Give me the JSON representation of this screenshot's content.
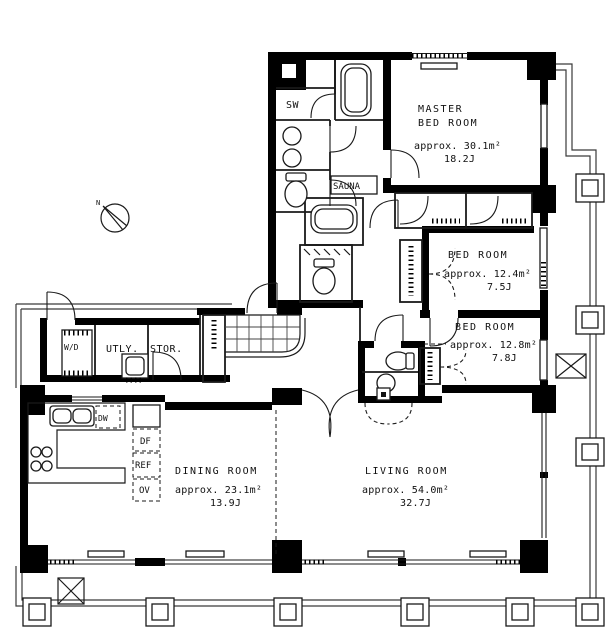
{
  "plan": {
    "type": "apartment-floor-plan",
    "rooms": [
      {
        "name": "MASTER",
        "name2": "BED ROOM",
        "area": "approx. 30.1m²",
        "tatami": "18.2J"
      },
      {
        "name": "BED ROOM",
        "area": "approx. 12.4m²",
        "tatami": "7.5J"
      },
      {
        "name": "BED ROOM",
        "area": "approx. 12.8m²",
        "tatami": "7.8J"
      },
      {
        "name": "DINING ROOM",
        "area": "approx. 23.1m²",
        "tatami": "13.9J"
      },
      {
        "name": "LIVING ROOM",
        "area": "approx. 54.0m²",
        "tatami": "32.7J"
      }
    ],
    "labels": {
      "shower": "SW",
      "sauna": "SAUNA",
      "utility": "UTLY.",
      "storage": "STOR.",
      "washer": "W/D",
      "dishwasher": "DW",
      "freezer": "DF",
      "fridge": "REF",
      "oven": "OV"
    },
    "compass_north": "N",
    "colors": {
      "wall": "#000000",
      "line": "#1a1a1a",
      "background": "#ffffff"
    }
  }
}
